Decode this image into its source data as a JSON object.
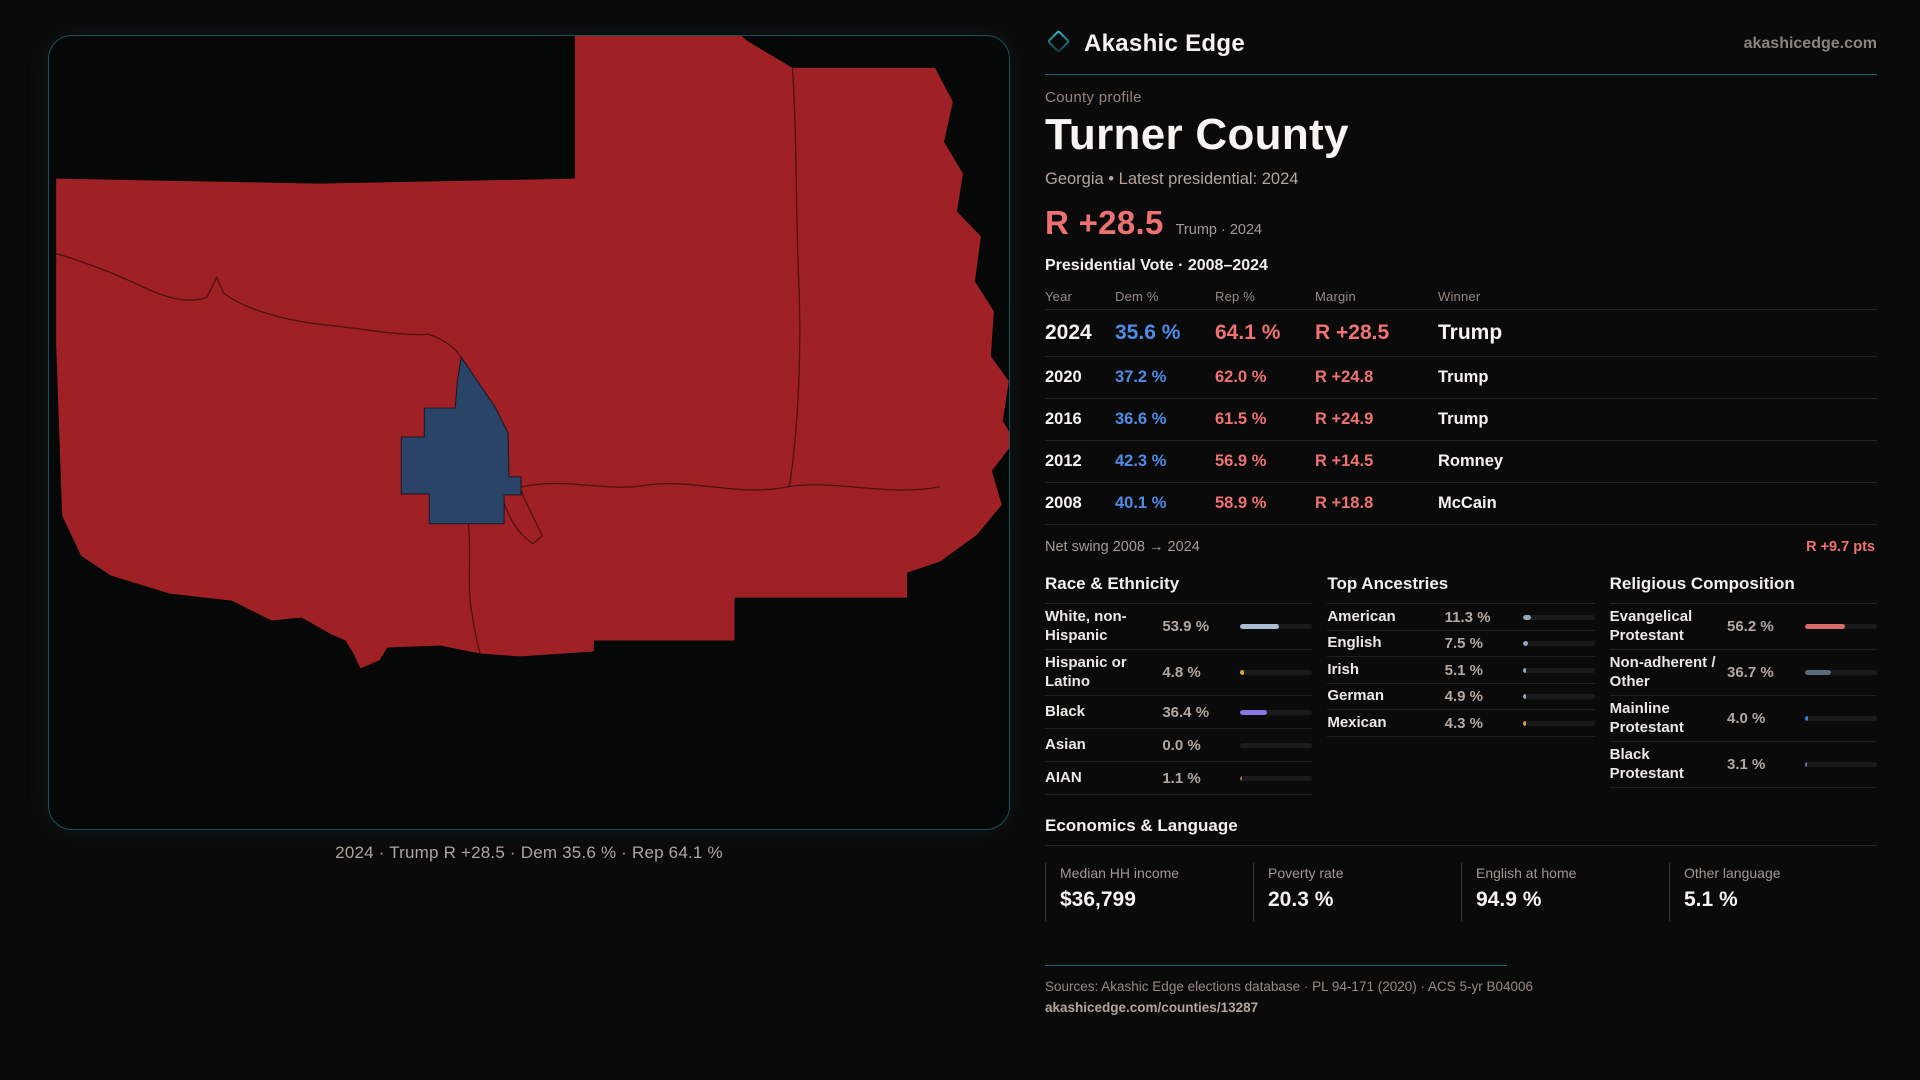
{
  "brand": {
    "name": "Akashic Edge",
    "site": "akashicedge.com"
  },
  "profile": {
    "kicker": "County profile",
    "title": "Turner County",
    "subtitle": "Georgia • Latest presidential: 2024",
    "headline_margin": "R +28.5",
    "headline_context": "Trump · 2024"
  },
  "map": {
    "caption": "2024 · Trump R +28.5 · Dem 35.6 % · Rep 64.1 %",
    "region_color": "#a02125",
    "county_color": "#2a4468"
  },
  "table": {
    "title": "Presidential Vote · 2008–2024",
    "columns": {
      "year": "Year",
      "dem": "Dem %",
      "rep": "Rep %",
      "margin": "Margin",
      "winner": "Winner"
    },
    "rows": [
      {
        "year": "2024",
        "dem": "35.6 %",
        "rep": "64.1 %",
        "margin": "R +28.5",
        "winner": "Trump"
      },
      {
        "year": "2020",
        "dem": "37.2 %",
        "rep": "62.0 %",
        "margin": "R +24.8",
        "winner": "Trump"
      },
      {
        "year": "2016",
        "dem": "36.6 %",
        "rep": "61.5 %",
        "margin": "R +24.9",
        "winner": "Trump"
      },
      {
        "year": "2012",
        "dem": "42.3 %",
        "rep": "56.9 %",
        "margin": "R +14.5",
        "winner": "Romney"
      },
      {
        "year": "2008",
        "dem": "40.1 %",
        "rep": "58.9 %",
        "margin": "R +18.8",
        "winner": "McCain"
      }
    ],
    "net_swing_label": "Net swing 2008 → 2024",
    "net_swing_value": "R +9.7 pts"
  },
  "race": {
    "title": "Race & Ethnicity",
    "rows": [
      {
        "label": "White, non-Hispanic",
        "value": "53.9 %",
        "pct": 53.9,
        "color": "#a9bdd3"
      },
      {
        "label": "Hispanic or Latino",
        "value": "4.8 %",
        "pct": 4.8,
        "color": "#e0a33c"
      },
      {
        "label": "Black",
        "value": "36.4 %",
        "pct": 36.4,
        "color": "#8677e2"
      },
      {
        "label": "Asian",
        "value": "0.0 %",
        "pct": 0,
        "color": "#8fa7bd"
      },
      {
        "label": "AIAN",
        "value": "1.1 %",
        "pct": 1.1,
        "color": "#b06a28"
      }
    ]
  },
  "ancestries": {
    "title": "Top Ancestries",
    "rows": [
      {
        "label": "American",
        "value": "11.3 %",
        "pct": 11.3,
        "color": "#8fa7bd"
      },
      {
        "label": "English",
        "value": "7.5 %",
        "pct": 7.5,
        "color": "#8fa7bd"
      },
      {
        "label": "Irish",
        "value": "5.1 %",
        "pct": 5.1,
        "color": "#8fa7bd"
      },
      {
        "label": "German",
        "value": "4.9 %",
        "pct": 4.9,
        "color": "#8fa7bd"
      },
      {
        "label": "Mexican",
        "value": "4.3 %",
        "pct": 4.3,
        "color": "#e0a33c"
      }
    ]
  },
  "religion": {
    "title": "Religious Composition",
    "rows": [
      {
        "label": "Evangelical Protestant",
        "value": "56.2 %",
        "pct": 56.2,
        "color": "#d96868"
      },
      {
        "label": "Non-adherent / Other",
        "value": "36.7 %",
        "pct": 36.7,
        "color": "#5d6a7c"
      },
      {
        "label": "Mainline Protestant",
        "value": "4.0 %",
        "pct": 4.0,
        "color": "#3f7fd9"
      },
      {
        "label": "Black Protestant",
        "value": "3.1 %",
        "pct": 3.1,
        "color": "#7d6ee0"
      }
    ]
  },
  "economics": {
    "title": "Economics & Language",
    "stats": [
      {
        "label": "Median HH income",
        "value": "$36,799"
      },
      {
        "label": "Poverty rate",
        "value": "20.3 %"
      },
      {
        "label": "English at home",
        "value": "94.9 %"
      },
      {
        "label": "Other language",
        "value": "5.1 %"
      }
    ]
  },
  "footer": {
    "sources": "Sources: Akashic Edge elections database · PL 94-171 (2020) · ACS 5-yr B04006",
    "permalink": "akashicedge.com/counties/13287"
  },
  "colors": {
    "accent_teal": "#1c616f",
    "dem_blue": "#4f8ce8",
    "rep_red": "#ee7272",
    "margin_salmon": "#ee7171"
  }
}
